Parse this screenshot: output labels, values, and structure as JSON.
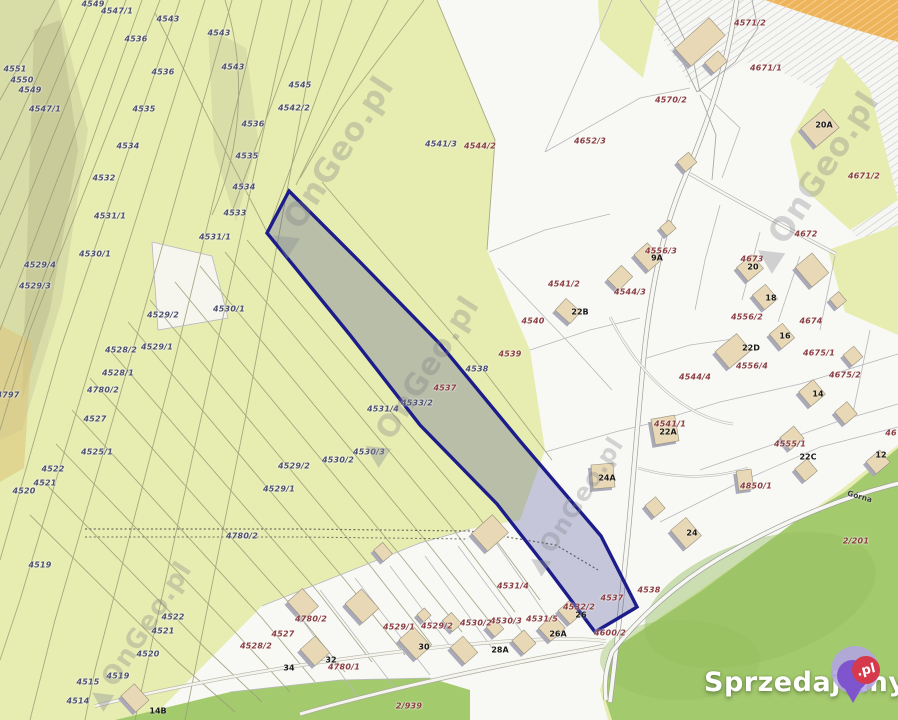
{
  "map_title": "cadastral parcel map",
  "watermark": {
    "text": "OnGeo.pl",
    "positions": [
      {
        "x": 330,
        "y": 165,
        "size": 32
      },
      {
        "x": 420,
        "y": 380,
        "size": 30
      },
      {
        "x": 815,
        "y": 180,
        "size": 32
      },
      {
        "x": 140,
        "y": 635,
        "size": 26
      },
      {
        "x": 575,
        "y": 505,
        "size": 24
      }
    ]
  },
  "logo": {
    "text": "Sprzedajemy",
    "suffix": ".pl"
  },
  "street": {
    "name": "Górna",
    "x": 861,
    "y": 497,
    "rot": 16
  },
  "highlight": {
    "parcel": "4537",
    "border": "#1c1c8a",
    "fill": "rgba(64,64,148,0.27)",
    "points": "289,191 267,233 350,335 420,425 497,504 547,568 595,632 637,607 601,536 520,441 440,344 360,262"
  },
  "colors": {
    "parcel_green": "#e7edb0",
    "meadow_green": "#a4ca6e",
    "white_area": "#f8f8f4",
    "label_green_tone": "#4c4f6e",
    "label_white_tone": "#8a3d42",
    "building_fill": "#e8d8b5",
    "building_shadow": "#a9a9b8",
    "orange_hatch": "#eeb45c"
  },
  "parcel_labels": [
    {
      "t": "4549",
      "x": 93,
      "y": 4,
      "v": "g"
    },
    {
      "t": "4547/1",
      "x": 117,
      "y": 11,
      "v": "g"
    },
    {
      "t": "4543",
      "x": 168,
      "y": 19,
      "v": "g"
    },
    {
      "t": "4543",
      "x": 219,
      "y": 33,
      "v": "g"
    },
    {
      "t": "4536",
      "x": 136,
      "y": 39,
      "v": "g"
    },
    {
      "t": "4551",
      "x": 15,
      "y": 69,
      "v": "g"
    },
    {
      "t": "4536",
      "x": 163,
      "y": 72,
      "v": "g"
    },
    {
      "t": "4543",
      "x": 233,
      "y": 67,
      "v": "g"
    },
    {
      "t": "4550",
      "x": 22,
      "y": 80,
      "v": "g"
    },
    {
      "t": "4545",
      "x": 300,
      "y": 85,
      "v": "g"
    },
    {
      "t": "4549",
      "x": 30,
      "y": 90,
      "v": "g"
    },
    {
      "t": "4542/2",
      "x": 294,
      "y": 108,
      "v": "g"
    },
    {
      "t": "4547/1",
      "x": 45,
      "y": 109,
      "v": "g"
    },
    {
      "t": "4535",
      "x": 144,
      "y": 109,
      "v": "g"
    },
    {
      "t": "4536",
      "x": 253,
      "y": 124,
      "v": "g"
    },
    {
      "t": "4534",
      "x": 128,
      "y": 146,
      "v": "g"
    },
    {
      "t": "4541/3",
      "x": 441,
      "y": 144,
      "v": "g"
    },
    {
      "t": "4544/2",
      "x": 480,
      "y": 146,
      "v": "w"
    },
    {
      "t": "4652/3",
      "x": 590,
      "y": 141,
      "v": "w"
    },
    {
      "t": "4535",
      "x": 247,
      "y": 156,
      "v": "g"
    },
    {
      "t": "4532",
      "x": 104,
      "y": 178,
      "v": "g"
    },
    {
      "t": "4534",
      "x": 244,
      "y": 187,
      "v": "g"
    },
    {
      "t": "4533",
      "x": 235,
      "y": 213,
      "v": "g"
    },
    {
      "t": "4531/1",
      "x": 110,
      "y": 216,
      "v": "g"
    },
    {
      "t": "4531/1",
      "x": 215,
      "y": 237,
      "v": "g"
    },
    {
      "t": "4530/1",
      "x": 95,
      "y": 254,
      "v": "g"
    },
    {
      "t": "4529/4",
      "x": 40,
      "y": 265,
      "v": "g"
    },
    {
      "t": "4529/3",
      "x": 35,
      "y": 286,
      "v": "g"
    },
    {
      "t": "4530/1",
      "x": 229,
      "y": 309,
      "v": "g"
    },
    {
      "t": "4529/2",
      "x": 163,
      "y": 315,
      "v": "g"
    },
    {
      "t": "4529/1",
      "x": 157,
      "y": 347,
      "v": "g"
    },
    {
      "t": "4528/2",
      "x": 121,
      "y": 350,
      "v": "g"
    },
    {
      "t": "4528/1",
      "x": 118,
      "y": 373,
      "v": "g"
    },
    {
      "t": "4780/2",
      "x": 103,
      "y": 390,
      "v": "g"
    },
    {
      "t": "4797",
      "x": 8,
      "y": 395,
      "v": "g"
    },
    {
      "t": "4533/2",
      "x": 417,
      "y": 403,
      "v": "g"
    },
    {
      "t": "4531/4",
      "x": 383,
      "y": 409,
      "v": "g"
    },
    {
      "t": "4527",
      "x": 95,
      "y": 419,
      "v": "g"
    },
    {
      "t": "4530/3",
      "x": 369,
      "y": 452,
      "v": "g"
    },
    {
      "t": "4525/1",
      "x": 97,
      "y": 452,
      "v": "g"
    },
    {
      "t": "4530/2",
      "x": 338,
      "y": 460,
      "v": "g"
    },
    {
      "t": "4529/2",
      "x": 294,
      "y": 466,
      "v": "g"
    },
    {
      "t": "4522",
      "x": 53,
      "y": 469,
      "v": "g"
    },
    {
      "t": "4521",
      "x": 45,
      "y": 483,
      "v": "g"
    },
    {
      "t": "4520",
      "x": 24,
      "y": 491,
      "v": "g"
    },
    {
      "t": "4529/1",
      "x": 279,
      "y": 489,
      "v": "g"
    },
    {
      "t": "4571/2",
      "x": 750,
      "y": 23,
      "v": "w"
    },
    {
      "t": "4671/1",
      "x": 766,
      "y": 68,
      "v": "w"
    },
    {
      "t": "4570/2",
      "x": 671,
      "y": 100,
      "v": "w"
    },
    {
      "t": "4671/2",
      "x": 864,
      "y": 176,
      "v": "w"
    },
    {
      "t": "4672",
      "x": 806,
      "y": 234,
      "v": "w"
    },
    {
      "t": "4556/3",
      "x": 661,
      "y": 251,
      "v": "w"
    },
    {
      "t": "4673",
      "x": 752,
      "y": 259,
      "v": "w"
    },
    {
      "t": "4541/2",
      "x": 564,
      "y": 284,
      "v": "w"
    },
    {
      "t": "4544/3",
      "x": 630,
      "y": 292,
      "v": "w"
    },
    {
      "t": "4556/2",
      "x": 747,
      "y": 317,
      "v": "w"
    },
    {
      "t": "4674",
      "x": 811,
      "y": 321,
      "v": "w"
    },
    {
      "t": "4540",
      "x": 533,
      "y": 321,
      "v": "w"
    },
    {
      "t": "4539",
      "x": 510,
      "y": 354,
      "v": "w"
    },
    {
      "t": "4675/1",
      "x": 819,
      "y": 353,
      "v": "w"
    },
    {
      "t": "4556/4",
      "x": 752,
      "y": 366,
      "v": "w"
    },
    {
      "t": "4538",
      "x": 477,
      "y": 369,
      "v": "g"
    },
    {
      "t": "4675/2",
      "x": 845,
      "y": 375,
      "v": "w"
    },
    {
      "t": "4544/4",
      "x": 695,
      "y": 377,
      "v": "w"
    },
    {
      "t": "4537",
      "x": 445,
      "y": 388,
      "v": "w"
    },
    {
      "t": "4541/1",
      "x": 670,
      "y": 424,
      "v": "w"
    },
    {
      "t": "46",
      "x": 891,
      "y": 433,
      "v": "w"
    },
    {
      "t": "4555/1",
      "x": 790,
      "y": 444,
      "v": "w"
    },
    {
      "t": "4850/1",
      "x": 756,
      "y": 486,
      "v": "w"
    },
    {
      "t": "4780/2",
      "x": 242,
      "y": 536,
      "v": "g"
    },
    {
      "t": "2/201",
      "x": 856,
      "y": 541,
      "v": "w"
    },
    {
      "t": "4519",
      "x": 40,
      "y": 565,
      "v": "g"
    },
    {
      "t": "4531/4",
      "x": 513,
      "y": 586,
      "v": "w"
    },
    {
      "t": "4537",
      "x": 612,
      "y": 598,
      "v": "w"
    },
    {
      "t": "4538",
      "x": 649,
      "y": 590,
      "v": "w"
    },
    {
      "t": "4532/2",
      "x": 579,
      "y": 607,
      "v": "w"
    },
    {
      "t": "4522",
      "x": 173,
      "y": 617,
      "v": "g"
    },
    {
      "t": "4780/2",
      "x": 311,
      "y": 619,
      "v": "w"
    },
    {
      "t": "4531/5",
      "x": 542,
      "y": 619,
      "v": "w"
    },
    {
      "t": "4530/3",
      "x": 506,
      "y": 621,
      "v": "w"
    },
    {
      "t": "4530/2",
      "x": 476,
      "y": 623,
      "v": "w"
    },
    {
      "t": "4529/2",
      "x": 437,
      "y": 626,
      "v": "w"
    },
    {
      "t": "4529/1",
      "x": 399,
      "y": 627,
      "v": "w"
    },
    {
      "t": "4521",
      "x": 163,
      "y": 631,
      "v": "g"
    },
    {
      "t": "4600/2",
      "x": 610,
      "y": 633,
      "v": "w"
    },
    {
      "t": "4527",
      "x": 283,
      "y": 634,
      "v": "w"
    },
    {
      "t": "4528/2",
      "x": 256,
      "y": 646,
      "v": "w"
    },
    {
      "t": "4520",
      "x": 148,
      "y": 654,
      "v": "g"
    },
    {
      "t": "4780/1",
      "x": 344,
      "y": 667,
      "v": "w"
    },
    {
      "t": "4519",
      "x": 118,
      "y": 676,
      "v": "g"
    },
    {
      "t": "4515",
      "x": 88,
      "y": 682,
      "v": "g"
    },
    {
      "t": "4514",
      "x": 78,
      "y": 701,
      "v": "g"
    },
    {
      "t": "2/939",
      "x": 409,
      "y": 706,
      "v": "w"
    }
  ],
  "building_labels": [
    {
      "t": "20A",
      "x": 824,
      "y": 125
    },
    {
      "t": "9A",
      "x": 657,
      "y": 258
    },
    {
      "t": "20",
      "x": 753,
      "y": 267
    },
    {
      "t": "18",
      "x": 771,
      "y": 298
    },
    {
      "t": "22B",
      "x": 580,
      "y": 312
    },
    {
      "t": "16",
      "x": 785,
      "y": 336
    },
    {
      "t": "22D",
      "x": 751,
      "y": 348
    },
    {
      "t": "14",
      "x": 818,
      "y": 394
    },
    {
      "t": "12",
      "x": 881,
      "y": 455
    },
    {
      "t": "22C",
      "x": 808,
      "y": 457
    },
    {
      "t": "22A",
      "x": 668,
      "y": 432
    },
    {
      "t": "24A",
      "x": 607,
      "y": 478
    },
    {
      "t": "24",
      "x": 692,
      "y": 533
    },
    {
      "t": "26",
      "x": 581,
      "y": 615
    },
    {
      "t": "26A",
      "x": 558,
      "y": 634
    },
    {
      "t": "28A",
      "x": 500,
      "y": 650
    },
    {
      "t": "30",
      "x": 424,
      "y": 647
    },
    {
      "t": "32",
      "x": 331,
      "y": 660
    },
    {
      "t": "34",
      "x": 289,
      "y": 668
    },
    {
      "t": "14B",
      "x": 158,
      "y": 711
    }
  ],
  "buildings": [
    [
      700,
      42,
      46,
      24,
      -42
    ],
    [
      716,
      62,
      18,
      14,
      -42
    ],
    [
      820,
      128,
      30,
      24,
      -40
    ],
    [
      687,
      162,
      15,
      13,
      -40
    ],
    [
      668,
      228,
      12,
      11,
      -40
    ],
    [
      648,
      257,
      18,
      22,
      -42
    ],
    [
      620,
      278,
      20,
      16,
      -45
    ],
    [
      568,
      311,
      16,
      20,
      -48
    ],
    [
      750,
      268,
      20,
      18,
      -40
    ],
    [
      765,
      297,
      17,
      19,
      -40
    ],
    [
      812,
      270,
      22,
      26,
      -40
    ],
    [
      782,
      336,
      17,
      19,
      -40
    ],
    [
      733,
      351,
      28,
      22,
      -40
    ],
    [
      812,
      393,
      19,
      19,
      -40
    ],
    [
      838,
      300,
      12,
      12,
      -40
    ],
    [
      853,
      356,
      14,
      14,
      -40
    ],
    [
      846,
      413,
      16,
      16,
      -40
    ],
    [
      878,
      462,
      18,
      16,
      -40
    ],
    [
      806,
      470,
      16,
      16,
      -40
    ],
    [
      792,
      438,
      18,
      16,
      -40
    ],
    [
      745,
      480,
      15,
      20,
      -8
    ],
    [
      603,
      476,
      22,
      24,
      -5
    ],
    [
      665,
      430,
      24,
      26,
      -10
    ],
    [
      686,
      533,
      20,
      24,
      -40
    ],
    [
      655,
      507,
      14,
      15,
      -40
    ],
    [
      490,
      533,
      28,
      24,
      -42
    ],
    [
      383,
      552,
      12,
      15,
      -40
    ],
    [
      303,
      604,
      20,
      24,
      -42
    ],
    [
      362,
      606,
      22,
      26,
      -42
    ],
    [
      415,
      643,
      20,
      26,
      -42
    ],
    [
      452,
      622,
      12,
      15,
      -42
    ],
    [
      464,
      650,
      17,
      22,
      -42
    ],
    [
      495,
      628,
      12,
      13,
      -42
    ],
    [
      524,
      642,
      16,
      18,
      -42
    ],
    [
      552,
      628,
      20,
      18,
      -42
    ],
    [
      570,
      612,
      16,
      18,
      -42
    ],
    [
      315,
      651,
      20,
      22,
      -42
    ],
    [
      135,
      698,
      18,
      22,
      -42
    ],
    [
      424,
      615,
      10,
      10,
      -42
    ]
  ]
}
